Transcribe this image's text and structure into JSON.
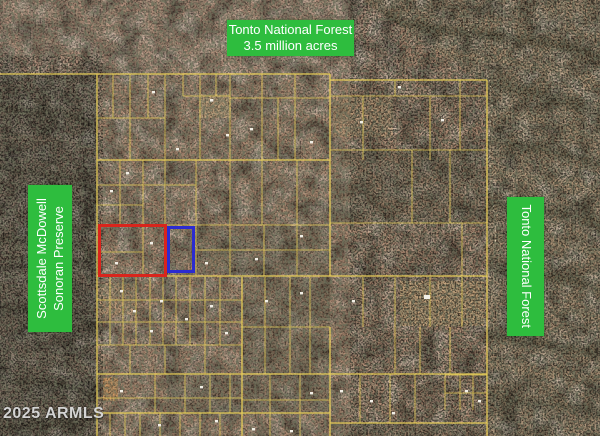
{
  "map": {
    "watermark": "2025 ARMLS",
    "labels": {
      "tonto_top": {
        "line1": "Tonto National Forest",
        "line2": "3.5 million acres"
      },
      "preserve_left": {
        "line1": "Scottsdale McDowell",
        "line2": "Sonoran Preserve"
      },
      "tonto_right": {
        "text": "Tonto National Forest"
      }
    },
    "legend_colors": {
      "label_background": "#2ebd3e",
      "label_text": "#ffffff",
      "parcel_line": "#ecd258",
      "subject_highlight_red": "#d9251c",
      "adjacent_highlight_blue": "#2b2bd0"
    }
  }
}
